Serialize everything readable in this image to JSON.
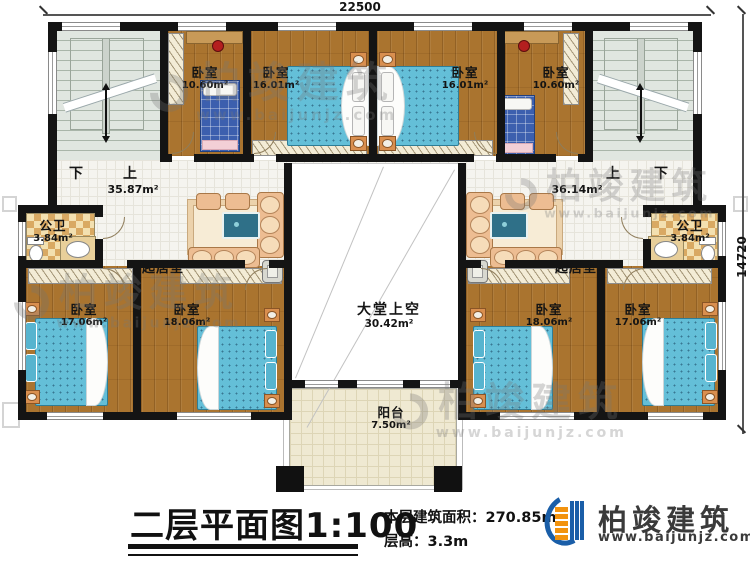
{
  "plan": {
    "dimensions": {
      "top": "22500",
      "right": "14720"
    },
    "stair_left": {
      "down": "下",
      "up": "上",
      "area": "35.87m²"
    },
    "stair_right": {
      "up": "上",
      "down": "下",
      "area": "36.14m²"
    },
    "bedrooms_top": [
      {
        "name": "卧室",
        "area": "10.60m²"
      },
      {
        "name": "卧室",
        "area": "16.01m²"
      },
      {
        "name": "卧室",
        "area": "16.01m²"
      },
      {
        "name": "卧室",
        "area": "10.60m²"
      }
    ],
    "bedrooms_bottom": [
      {
        "name": "卧室",
        "area": "17.06m²"
      },
      {
        "name": "卧室",
        "area": "18.06m²"
      },
      {
        "name": "卧室",
        "area": "18.06m²"
      },
      {
        "name": "卧室",
        "area": "17.06m²"
      }
    ],
    "bathrooms": [
      {
        "name": "公卫",
        "area": "3.84m²"
      },
      {
        "name": "公卫",
        "area": "3.84m²"
      }
    ],
    "living_rooms": [
      {
        "name": "起居室"
      },
      {
        "name": "起居室"
      }
    ],
    "hall_void": {
      "name": "大堂上空",
      "area": "30.42m²"
    },
    "balcony": {
      "name": "阳台",
      "area": "7.50m²"
    }
  },
  "title_block": {
    "title": "二层平面图",
    "scale": "1:100",
    "area_label": "本层建筑面积：",
    "area_value": "270.85m²",
    "floor_height_label": "层高：",
    "floor_height_value": "3.3m"
  },
  "brand": {
    "name": "柏竣建筑",
    "website": "www.baijunjz.com"
  },
  "watermark": {
    "name": "柏竣建筑",
    "website": "www.baijunjz.com"
  },
  "colors": {
    "wall": "#141414",
    "wood_floor": "#aa742f",
    "bed": "#64bfd8",
    "stair_floor": "#e0e6e0",
    "logo_blue": "#1a5ea8",
    "logo_orange": "#f2930f"
  }
}
